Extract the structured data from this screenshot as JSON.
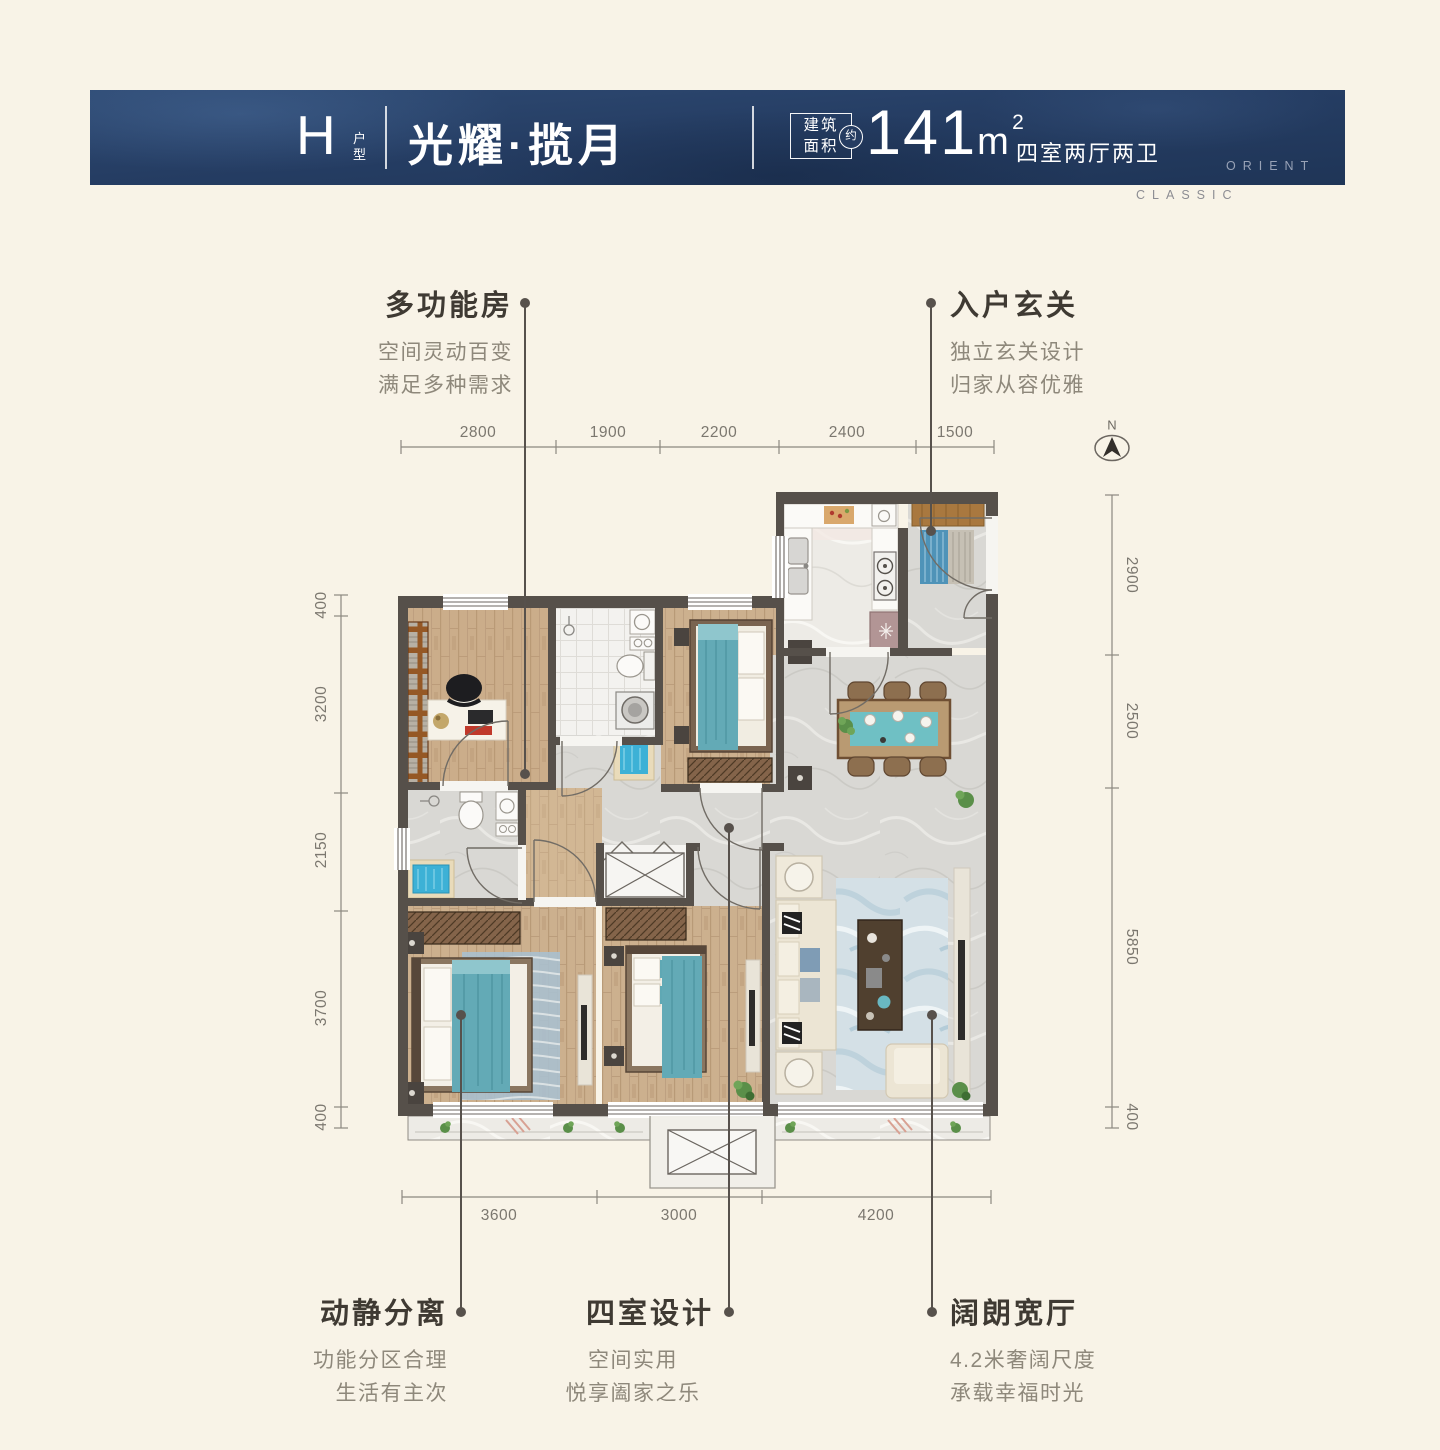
{
  "colors": {
    "background": "#f8f3e7",
    "banner_navy": "#253d63",
    "wall": "#56504a",
    "teal_accent": "#63aab6",
    "title_text": "#3f3a33",
    "subtitle_text": "#8e887b"
  },
  "header": {
    "unit_letter": "H",
    "unit_label": "户型",
    "name": "光耀·揽月",
    "area_box_line1": "建筑",
    "area_box_line2": "面积",
    "area_approx": "约",
    "area_value": "141",
    "area_unit": "m",
    "area_sup": "2",
    "layout_text": "四室两厅两卫",
    "brand_line1": "ORIENT",
    "brand_line2": "CLASSIC"
  },
  "callouts": [
    {
      "title": "多功能房",
      "line1": "空间灵动百变",
      "line2": "满足多种需求"
    },
    {
      "title": "入户玄关",
      "line1": "独立玄关设计",
      "line2": "归家从容优雅"
    },
    {
      "title": "动静分离",
      "line1": "功能分区合理",
      "line2": "生活有主次"
    },
    {
      "title": "四室设计",
      "line1": "空间实用",
      "line2": "悦享阖家之乐"
    },
    {
      "title": "阔朗宽厅",
      "line1": "4.2米奢阔尺度",
      "line2": "承载幸福时光"
    }
  ],
  "dimensions": {
    "top": [
      "2800",
      "1900",
      "2200",
      "2400",
      "1500"
    ],
    "bottom": [
      "3600",
      "3000",
      "4200"
    ],
    "left": [
      "400",
      "3200",
      "2150",
      "3700",
      "400"
    ],
    "right": [
      "2900",
      "2500",
      "5850",
      "400"
    ]
  },
  "compass": {
    "label": "N"
  }
}
